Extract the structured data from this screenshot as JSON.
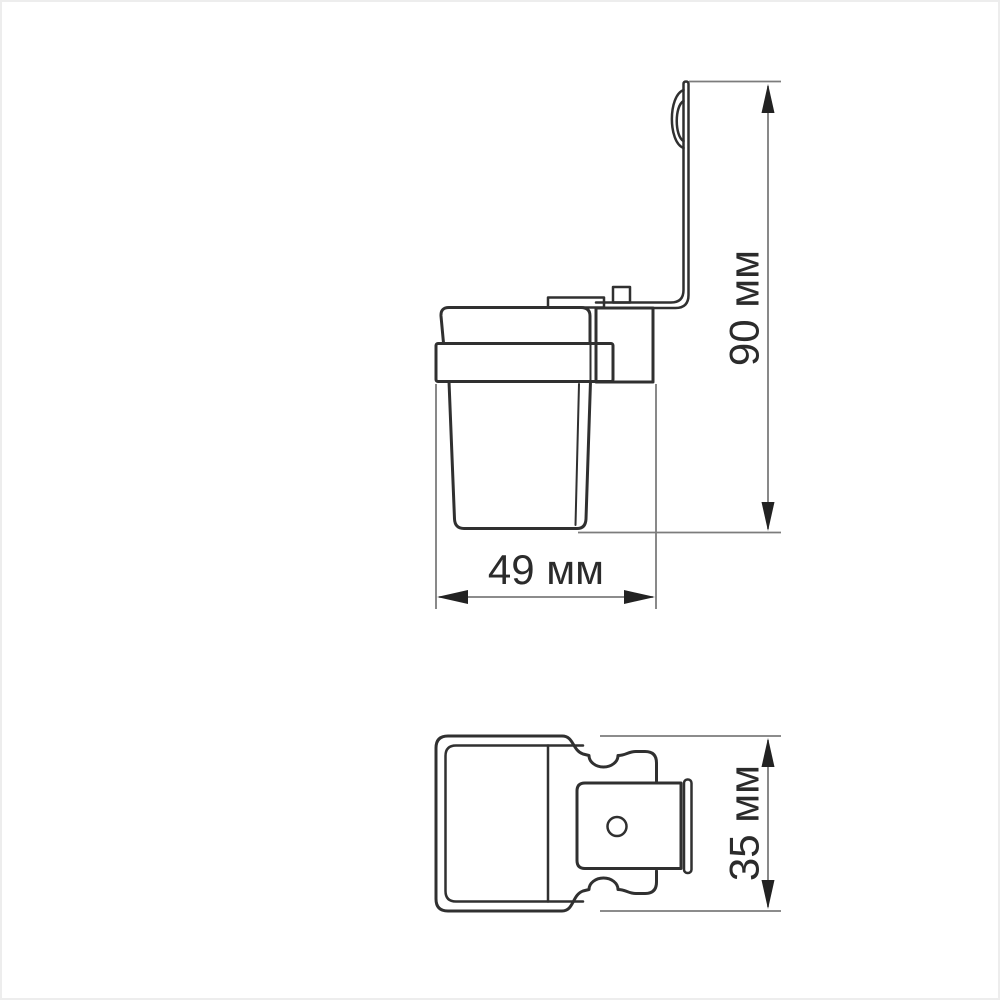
{
  "page": {
    "background_color": "#ffffff",
    "frame_color": "#ededed"
  },
  "style": {
    "drawing_line_color": "#303030",
    "dimension_line_color": "#7c7c7c",
    "arrow_color": "#222222",
    "label_color": "#2b2b2b"
  },
  "dimensions": [
    {
      "id": "height",
      "label": "90 мм",
      "value": 90,
      "unit": "мм",
      "orientation": "vertical"
    },
    {
      "id": "width",
      "label": "49 мм",
      "value": 49,
      "unit": "мм",
      "orientation": "horizontal"
    },
    {
      "id": "depth",
      "label": "35 мм",
      "value": 35,
      "unit": "мм",
      "orientation": "vertical"
    }
  ]
}
